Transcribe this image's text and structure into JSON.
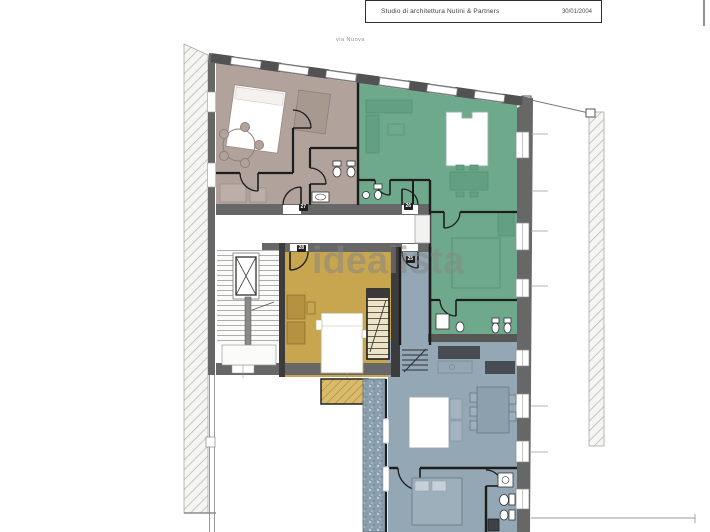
{
  "title_block": {
    "studio": "Studio di architettura Nutini & Partners",
    "date": "30/01/2004"
  },
  "street_label": "via Nuova",
  "watermark": "idealista",
  "door_tags": [
    {
      "label": "27"
    },
    {
      "label": "26"
    },
    {
      "label": "28"
    },
    {
      "label": "25"
    }
  ],
  "colors": {
    "wall_dark": "#676767",
    "wall_divider": "#3c3c3c",
    "wall_black": "#1d1d1d",
    "apartment_mauve": "#b1a29c",
    "apartment_green": "#6fa98c",
    "apartment_green_dark": "#63a081",
    "apartment_yellow": "#c7a64f",
    "apartment_blue": "#93a7b4",
    "terrace_blue": "#8ba0af",
    "balcony_yellow": "#d9bb6b",
    "hatch_gray": "#b5b5b2",
    "watermark_gray": "#868686"
  }
}
